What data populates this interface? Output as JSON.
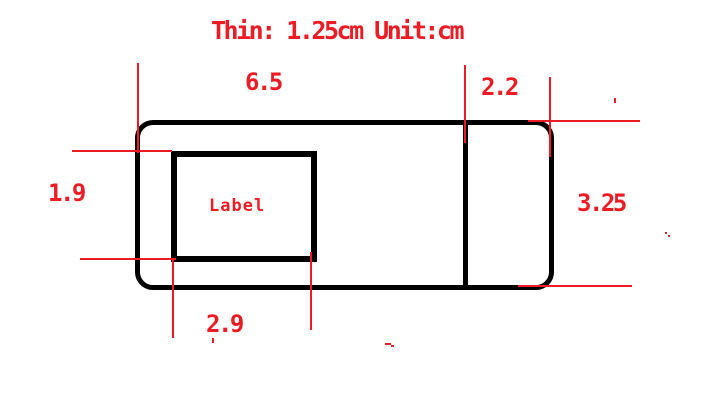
{
  "title": "Thin: 1.25cm Unit:cm",
  "shape_label": "Label",
  "dimensions": {
    "top_width": "6.5",
    "right_section_width": "2.2",
    "label_height": "1.9",
    "right_height": "3.25",
    "label_width": "2.9"
  },
  "colors": {
    "annotation_red": "#ED1C24",
    "shape_black": "#000000",
    "background": "#FFFFFF"
  }
}
